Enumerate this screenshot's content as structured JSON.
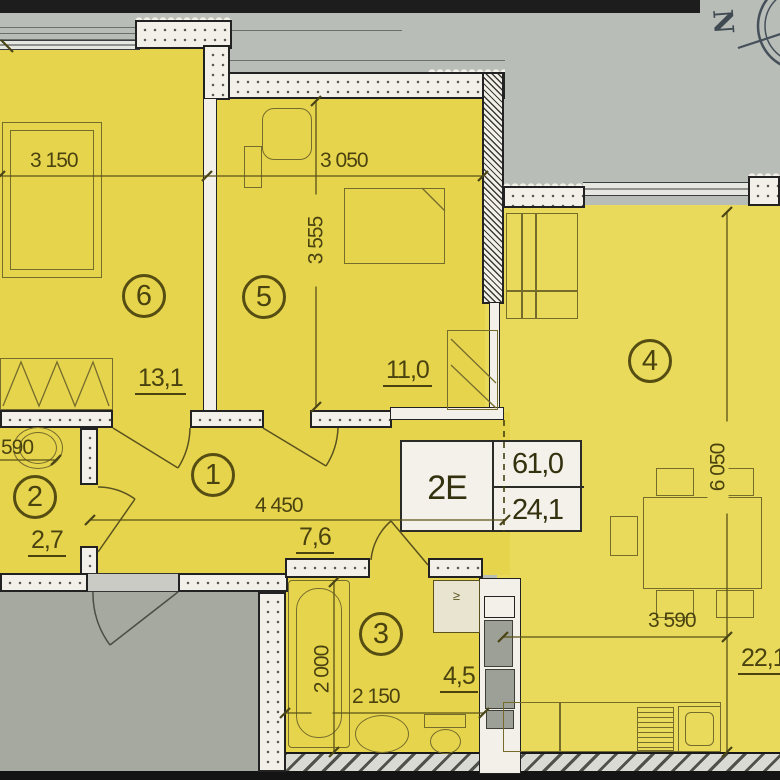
{
  "plan": {
    "unit_box": {
      "type": "2E",
      "value_top": "61,0",
      "value_bottom": "24,1"
    },
    "compass": {
      "letter": "N"
    },
    "rooms": [
      {
        "id": "1",
        "area": "7,6"
      },
      {
        "id": "2",
        "area": "2,7"
      },
      {
        "id": "3",
        "area": "4,5"
      },
      {
        "id": "4",
        "area": "22,1"
      },
      {
        "id": "5",
        "area": "11,0"
      },
      {
        "id": "6",
        "area": "13,1"
      }
    ],
    "dimensions": {
      "room6_width": "3 150",
      "room5_width": "3 050",
      "room5_depth": "3 555",
      "room4_width": "3 590",
      "room4_depth": "6 050",
      "hall_width": "4 450",
      "room2_width": "590",
      "room3_width": "2 150",
      "room3_depth": "2 000"
    },
    "symbols": {
      "washer": "≥"
    }
  }
}
